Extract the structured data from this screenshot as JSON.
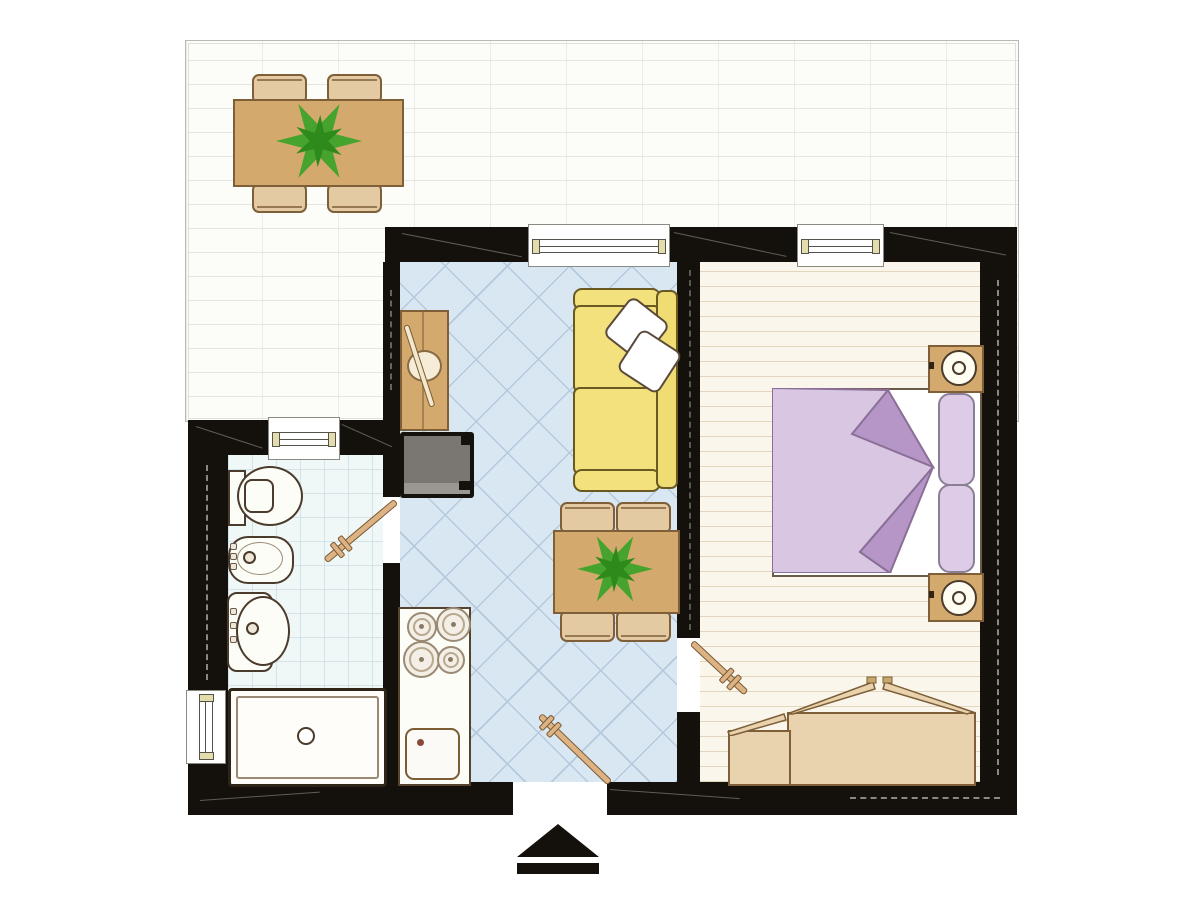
{
  "title": "apartment-floor-plan",
  "palette": {
    "wall": "#14100b",
    "terrace-floor": "#fcfcf9",
    "terrace-line": "#e6e4df",
    "terrace-line2": "#edebe6",
    "living-floor": "#d9e7f3",
    "living-line": "#b5c9dd",
    "bath-floor": "#f0f7f7",
    "bath-line": "#d2e4e9",
    "bed-floor": "#faf6ec",
    "bed-line": "#e3d6bd",
    "wood": "#d4a96d",
    "wood-dark": "#7e5f38",
    "wood-light": "#e8d3ae",
    "chair": "#e4caa2",
    "sofa": "#f2e17c",
    "sofa-dark": "#6a5a22",
    "blanket": "#d9c6e2",
    "blanket-dark": "#b596c6",
    "blanket-border": "#8b6f96",
    "pillow": "#ddcbe7",
    "fixture": "#fdfdf8",
    "fixture-border": "#4a3b2c",
    "tv": "#7a7672",
    "door": "#ddb284",
    "plant": "#46a42e",
    "plant-dark": "#2f8a1c",
    "arrow": "#14100b"
  },
  "plan": {
    "terrace": {
      "items": [
        "dining-table",
        "chair",
        "chair",
        "chair",
        "chair",
        "potted-plant"
      ]
    },
    "living_room": {
      "items": [
        "window",
        "desk",
        "desk-lamp",
        "tv-unit",
        "sofa",
        "pillow",
        "pillow",
        "dining-table",
        "potted-plant",
        "chair",
        "chair",
        "chair",
        "chair",
        "kitchen-counter",
        "stove-burners",
        "kitchen-sink",
        "entrance-door"
      ]
    },
    "bathroom": {
      "items": [
        "window",
        "window",
        "toilet",
        "bidet",
        "washbasin",
        "bathtub",
        "door"
      ]
    },
    "bedroom": {
      "items": [
        "window",
        "double-bed",
        "blanket",
        "pillow",
        "pillow",
        "nightstand",
        "nightstand",
        "table-lamp",
        "table-lamp",
        "wardrobe",
        "cabinet",
        "door"
      ]
    },
    "entrance_marker": "north-arrow"
  }
}
